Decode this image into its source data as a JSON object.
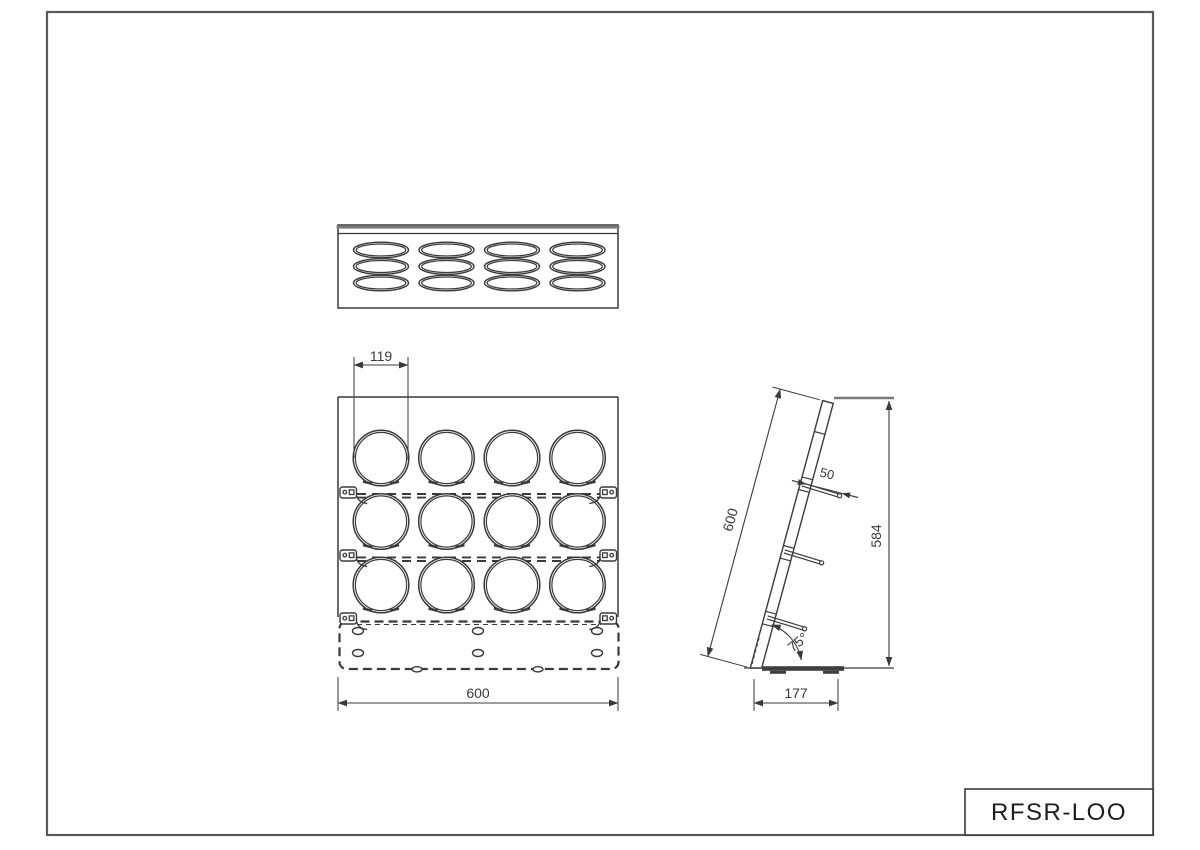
{
  "drawing": {
    "model": "RFSR-LOO",
    "dimensions": {
      "hole_diameter": "119",
      "rack_width": "600",
      "panel_length": "600",
      "pin_length": "50",
      "overall_height": "584",
      "tilt_angle": "75°",
      "base_depth": "177"
    },
    "layout_counts": {
      "hole_columns": 4,
      "hole_rows": 3,
      "total_holes": 12
    },
    "colors": {
      "line": "#3a3a3a",
      "frame": "#58595b",
      "heavy_line": "#7a7a7a",
      "background": "#ffffff"
    }
  }
}
